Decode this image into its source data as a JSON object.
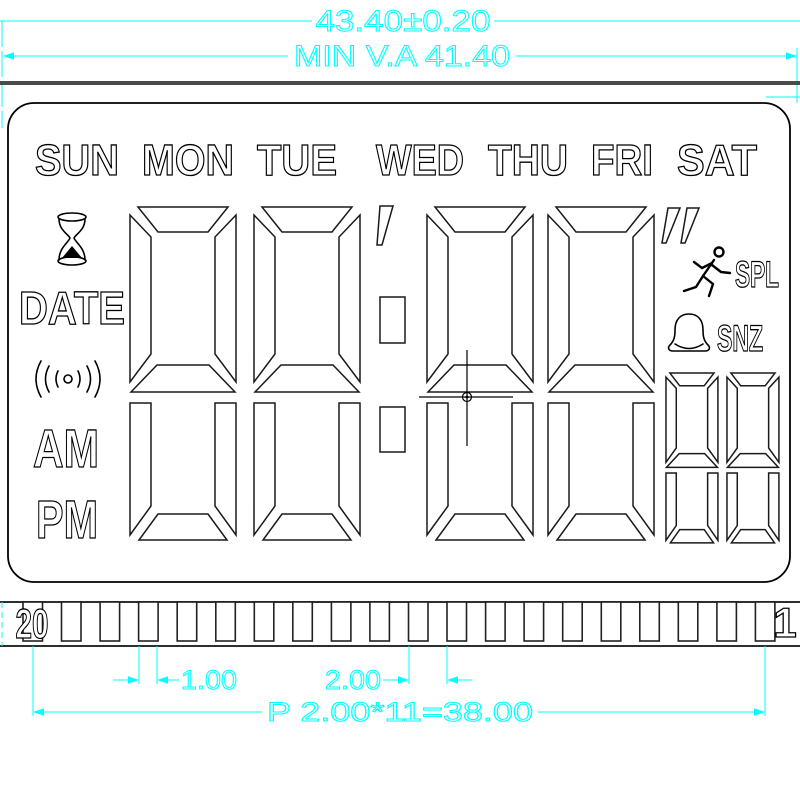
{
  "drawing_title": "LCD glass segment layout drawing",
  "dimensions": {
    "overall_width": "43.40±0.20",
    "viewing_area": "MIN  V.A  41.40",
    "pin_width": "1.00",
    "pin_pitch": "2.00",
    "pitch_total": "P  2.00*11=38.00"
  },
  "days": [
    "SUN",
    "MON",
    "TUE",
    "WED",
    "THU",
    "FRI",
    "SAT"
  ],
  "left_labels": {
    "date": "DATE",
    "am": "AM",
    "pm": "PM"
  },
  "right_labels": {
    "spl": "SPL",
    "snz": "SNZ"
  },
  "pins": {
    "count": 20,
    "first_label": "20",
    "last_label": "1"
  },
  "display": {
    "large_digits": 4,
    "small_digits": 2,
    "colon_dots": 2,
    "quote_marks": "' and ''"
  },
  "icons": [
    "hourglass-icon",
    "antenna-icon",
    "runner-icon",
    "bell-icon",
    "crosshair-cursor"
  ],
  "colors": {
    "dimension": "#00ffff",
    "outline": "#000000",
    "glass_edge": "#4a4a4a"
  }
}
